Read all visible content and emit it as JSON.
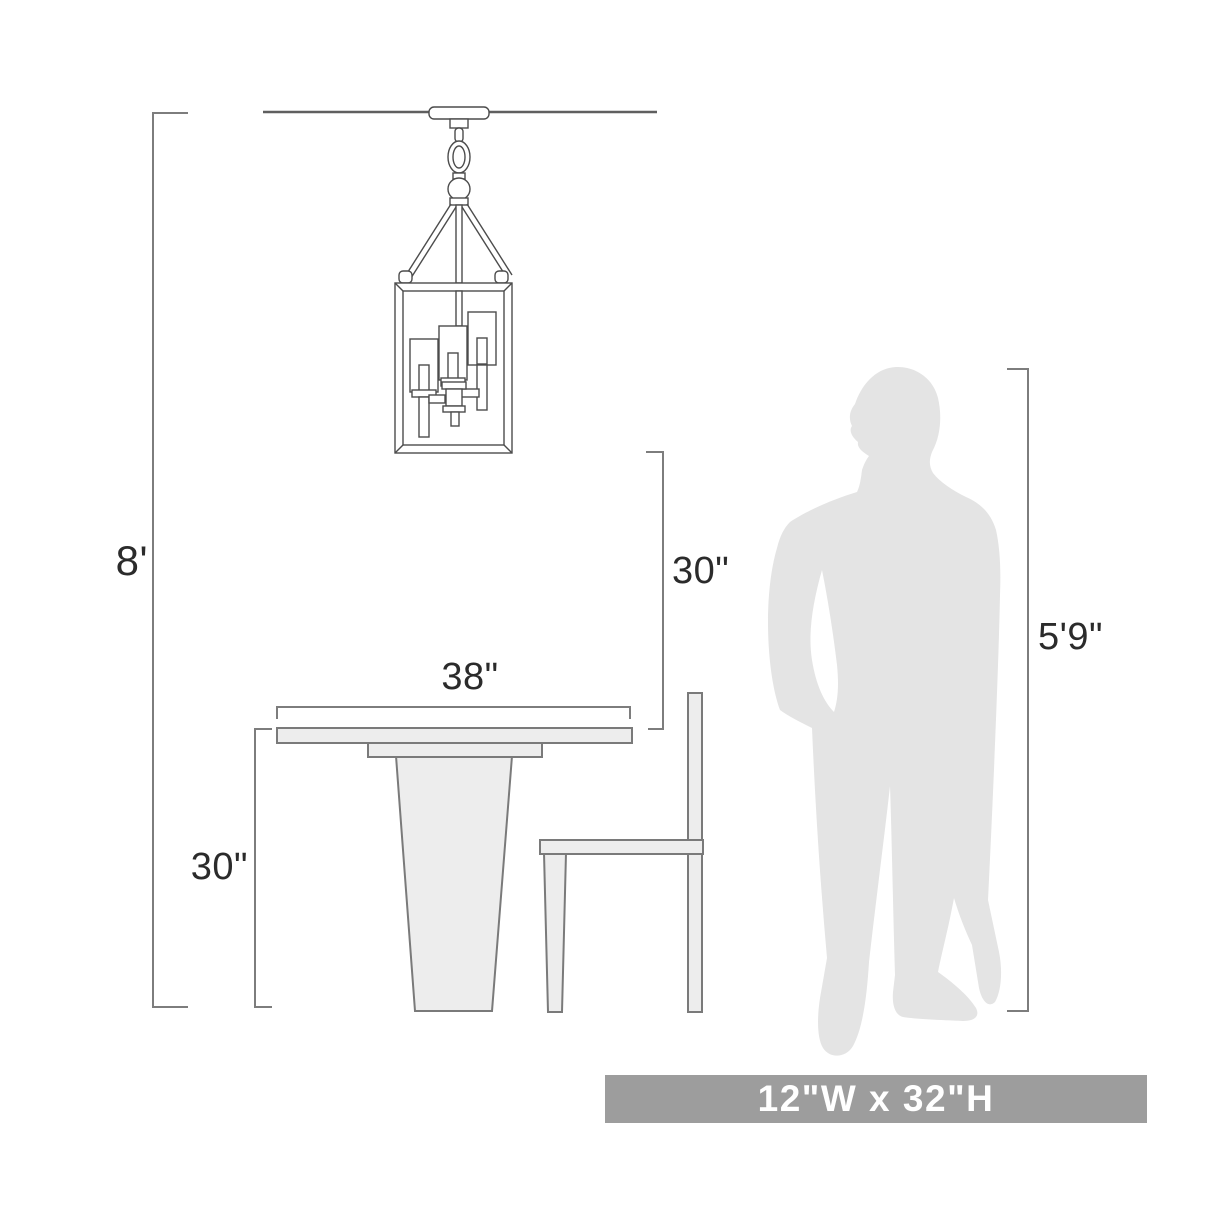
{
  "diagram": {
    "subject": "pendant light hanging over a pedestal dining table with side chair and standing person shown for scale"
  },
  "labels": {
    "ceiling_height": "8'",
    "fixture_to_table_clearance": "30\"",
    "table_width": "38\"",
    "table_height": "30\"",
    "person_height": "5'9\""
  },
  "banner": {
    "text": "12\"W x 32\"H",
    "bg": "#9d9d9d",
    "fg": "#ffffff"
  },
  "colors": {
    "background": "#ffffff",
    "drawing_line": "#4c4c4c",
    "ceiling_line": "#5f5f5f",
    "dimension_line": "#7d7d7d",
    "furniture_fill": "#ededed",
    "furniture_stroke": "#7a7a7a",
    "person_fill": "#e4e4e4",
    "label_text": "#2b2b2b"
  }
}
